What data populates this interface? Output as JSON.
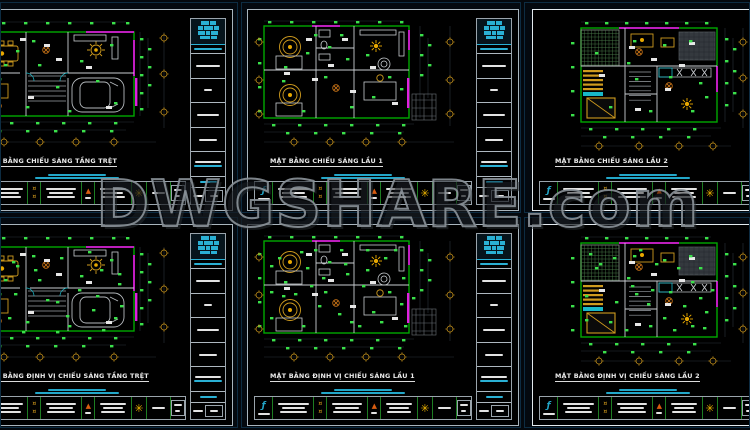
{
  "watermark": {
    "text": "DWGSHARE.com"
  },
  "icons": {
    "flower": "✳",
    "signature": "ƒ",
    "triangle": "▲",
    "lamp": "¤"
  },
  "colors": {
    "cad_green": "#00a800",
    "tick_green": "#3ae04a",
    "furniture_gold": "#cf9b1e",
    "highlight_yellow": "#e8a800",
    "magenta": "#d818d8",
    "cyan": "#2ab0d4",
    "sheet_border": "#a9b5bd",
    "watermark_outline": "#8b9299"
  },
  "panels": [
    {
      "id": "top-left",
      "title": "MẶT BẰNG CHIẾU SÁNG TẦNG TRỆT",
      "plan": "A",
      "dense": false
    },
    {
      "id": "top-center",
      "title": "MẶT BẰNG CHIẾU SÁNG LẦU 1",
      "plan": "B",
      "dense": false
    },
    {
      "id": "top-right",
      "title": "MẶT BẰNG CHIẾU SÁNG LẦU 2",
      "plan": "C",
      "dense": false
    },
    {
      "id": "bottom-left",
      "title": "MẶT BẰNG ĐỊNH VỊ CHIẾU SÁNG TẦNG TRỆT",
      "plan": "A",
      "dense": true
    },
    {
      "id": "bottom-center",
      "title": "MẶT BẰNG ĐỊNH VỊ CHIẾU SÁNG LẦU 1",
      "plan": "B",
      "dense": true
    },
    {
      "id": "bottom-right",
      "title": "MẶT BẰNG ĐỊNH VỊ CHIẾU SÁNG LẦU 2",
      "plan": "C",
      "dense": true
    }
  ]
}
